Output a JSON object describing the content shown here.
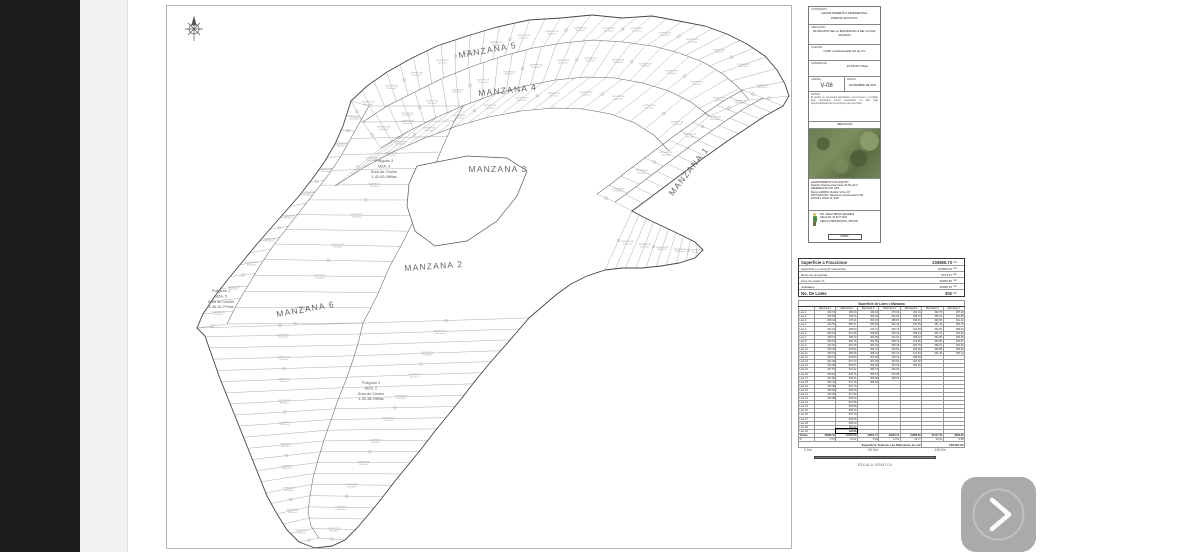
{
  "colors": {
    "viewer_bar": "#1c1c1e",
    "next_button_bg": "#a8aaac",
    "map_line": "#555555",
    "photo_green": "#6b7d52"
  },
  "viewer": {
    "next_button": {
      "icon": "chevron-right-icon"
    }
  },
  "sheet": {
    "map": {
      "manzana_labels": [
        {
          "text": "MANZANA 5",
          "x": 321,
          "y": 47,
          "rot": -10
        },
        {
          "text": "MANZANA 4",
          "x": 341,
          "y": 87,
          "rot": -6
        },
        {
          "text": "MANZANA 3",
          "x": 331,
          "y": 166,
          "rot": 0
        },
        {
          "text": "MANZANA 2",
          "x": 267,
          "y": 263,
          "rot": -4
        },
        {
          "text": "MANZANA 6",
          "x": 139,
          "y": 306,
          "rot": -10
        },
        {
          "text": "MANZANA 1",
          "x": 524,
          "y": 167,
          "rot": -52
        }
      ],
      "polygon_notes": [
        {
          "x": 217,
          "y": 156,
          "lines": [
            "Polígono 3",
            "MZA. 3",
            "Área de Cesión",
            "1-41-63.08Has"
          ]
        },
        {
          "x": 54,
          "y": 286,
          "lines": [
            "Polígono 1",
            "MZA. 5",
            "Área de Cesión",
            "4-46-16.27Has"
          ]
        },
        {
          "x": 204,
          "y": 378,
          "lines": [
            "Polígono 2",
            "MZA. 2",
            "Área de Cesión",
            "1-31-38.04Has"
          ]
        }
      ],
      "lot_label_sample": {
        "line1": "SUPERFICIE",
        "line2": "300.00m2"
      }
    },
    "title_block": {
      "contenido_label": "CONTENIDO:",
      "contenido1": "LEVANTAMIENTO PERIMETRAL",
      "contenido2": "PREDIO RUSTICO",
      "ubicacion_label": "UBICACION:",
      "ubicacion": "MUNICIPIO DE LA MANZANILLA DE LA PAZ, JALISCO",
      "cliente_label": "CLIENTE:",
      "cliente": "CORI La Manzanilla SA de CV",
      "superficie_label": "SUPERFICIE:",
      "superficie": "23-08-55.73Has",
      "lamina_label": "LAMINA:",
      "lamina": "V-08",
      "fecha_label": "FECHA:",
      "fecha": "NOVIEMBRE DE 2023",
      "notas_label": "NOTAS:",
      "notas": "El predio se encuentra delimitado y los linderos y medidas aquí mostrados fueron levantados en sitio bajo responsabilidad de los técnicos que suscriben.",
      "mapa_label": "UBICACION",
      "equipo_lines": [
        "LEVANTAMIENTO CON EQUIPO:",
        "Estación Total Geomax Zoom 30 Pro A6 X",
        "REFERENCIA CON GPS",
        "Marca GARMIN, Modelo \"eTrex 10\"",
        "PROYECCION: Sistema de coordenadas UTM",
        "WGS-84, ZONA 13, SUR"
      ],
      "firma_lines": [
        "ING. DIEGO BRAVO NEGRETE",
        "CELULAR: 33 3477 6403",
        "CEDULA PROFESIONAL: 5567234"
      ],
      "firma_box": "FIRMA"
    },
    "summary_table": {
      "rows": [
        {
          "label": "Superficie a Fraccionar",
          "value": "230855.73",
          "unit": "m2",
          "bold": true
        },
        {
          "label": "Superficie en venta (8 manzanas)",
          "value": "166655.02",
          "unit": "m2",
          "bold": false
        },
        {
          "label": "Resto de propiedad",
          "value": "6074.37",
          "unit": "m2",
          "bold": false
        },
        {
          "label": "Área de cesión        %",
          "value": "28056.85",
          "unit": "m2",
          "bold": false
        },
        {
          "label": "vialidades",
          "value": "25095.63",
          "unit": "m2",
          "bold": false
        },
        {
          "label": "No. De Lotes",
          "value": "302",
          "unit": "Pts",
          "bold": true
        }
      ]
    },
    "lot_table": {
      "title": "Superficie de Lotes x Manzana",
      "columns": [
        "",
        "Manzana 1",
        "Manzana 2",
        "Manzana 3",
        "Manzana 4",
        "Manzana 5",
        "Manzana 6",
        "Manzana 7"
      ],
      "rows": [
        {
          "l": "Lote 1",
          "c": [
            "302.15",
            "465.20",
            "346.18",
            "378.92",
            "451.10",
            "362.75",
            "287.40"
          ]
        },
        {
          "l": "Lote 2",
          "c": [
            "315.80",
            "492.64",
            "352.30",
            "391.45",
            "448.72",
            "355.18",
            "292.85"
          ]
        },
        {
          "l": "Lote 3",
          "c": [
            "298.42",
            "478.11",
            "360.25",
            "385.60",
            "459.31",
            "348.90",
            "301.12"
          ]
        },
        {
          "l": "Lote 4",
          "c": [
            "310.55",
            "505.37",
            "355.48",
            "402.18",
            "470.25",
            "351.42",
            "296.70"
          ]
        },
        {
          "l": "Lote 5",
          "c": [
            "322.18",
            "488.90",
            "349.12",
            "398.75",
            "462.80",
            "360.05",
            "288.94"
          ]
        },
        {
          "l": "Lote 6",
          "c": [
            "305.92",
            "512.45",
            "358.60",
            "405.32",
            "455.14",
            "357.22",
            "294.36"
          ]
        },
        {
          "l": "Lote 7",
          "c": [
            "318.27",
            "495.72",
            "362.85",
            "412.90",
            "468.42",
            "352.60",
            "299.48"
          ]
        },
        {
          "l": "Lote 8",
          "c": [
            "300.64",
            "520.18",
            "351.95",
            "408.15",
            "472.90",
            "346.85",
            "290.57"
          ]
        },
        {
          "l": "Lote 9",
          "c": [
            "312.81",
            "502.35",
            "365.20",
            "395.48",
            "460.75",
            "358.12",
            "302.26"
          ]
        },
        {
          "l": "Lote 10",
          "c": [
            "325.48",
            "515.82",
            "354.70",
            "415.60",
            "466.38",
            "349.85",
            "286.92"
          ]
        },
        {
          "l": "Lote 11",
          "c": [
            "308.15",
            "498.26",
            "368.42",
            "401.22",
            "471.84",
            "361.48",
            "295.14"
          ]
        },
        {
          "l": "Lote 12",
          "c": [
            "320.72",
            "524.60",
            "357.90",
            "418.35",
            "458.26",
            "",
            ""
          ]
        },
        {
          "l": "Lote 13",
          "c": [
            "302.38",
            "507.14",
            "361.25",
            "394.80",
            "464.52",
            "",
            ""
          ]
        },
        {
          "l": "Lote 14",
          "c": [
            "314.95",
            "519.87",
            "352.48",
            "410.46",
            "469.15",
            "",
            ""
          ]
        },
        {
          "l": "Lote 15",
          "c": [
            "327.52",
            "501.32",
            "366.70",
            "406.92",
            "",
            "",
            ""
          ]
        },
        {
          "l": "Lote 16",
          "c": [
            "309.18",
            "526.75",
            "356.15",
            "413.58",
            "",
            "",
            ""
          ]
        },
        {
          "l": "Lote 17",
          "c": [
            "321.85",
            "508.41",
            "369.38",
            "399.24",
            "",
            "",
            ""
          ]
        },
        {
          "l": "Lote 18",
          "c": [
            "303.42",
            "531.16",
            "358.62",
            "",
            "",
            "",
            ""
          ]
        },
        {
          "l": "Lote 19",
          "c": [
            "316.08",
            "513.70",
            "",
            "",
            "",
            "",
            ""
          ]
        },
        {
          "l": "Lote 20",
          "c": [
            "328.65",
            "535.28",
            "",
            "",
            "",
            "",
            ""
          ]
        },
        {
          "l": "Lote 21",
          "c": [
            "310.22",
            "517.84",
            "",
            "",
            "",
            "",
            ""
          ]
        },
        {
          "l": "Lote 22",
          "c": [
            "322.88",
            "539.42",
            "",
            "",
            "",
            "",
            ""
          ]
        },
        {
          "l": "Lote 23",
          "c": [
            "",
            "521.95",
            "",
            "",
            "",
            "",
            ""
          ]
        },
        {
          "l": "Lote 24",
          "c": [
            "",
            "543.58",
            "",
            "",
            "",
            "",
            ""
          ]
        },
        {
          "l": "Lote 25",
          "c": [
            "",
            "526.12",
            "",
            "",
            "",
            "",
            ""
          ]
        },
        {
          "l": "Lote 26",
          "c": [
            "",
            "547.70",
            "",
            "",
            "",
            "",
            ""
          ]
        },
        {
          "l": "Lote 27",
          "c": [
            "",
            "530.25",
            "",
            "",
            "",
            "",
            ""
          ]
        },
        {
          "l": "Lote 28",
          "c": [
            "",
            "538.40",
            "",
            "",
            "",
            "",
            ""
          ]
        },
        {
          "l": "Lote 29",
          "c": [
            "",
            "150.84",
            "",
            "",
            "",
            "",
            ""
          ]
        },
        {
          "l": "Lote 30",
          "c": [
            "",
            "128.98",
            "",
            "",
            "",
            "",
            ""
          ]
        }
      ],
      "boxed_cell": {
        "row": 29,
        "col": 1
      },
      "totals_label": "Totales",
      "totals": [
        "30888.02",
        "47560.39",
        "22851.77",
        "29940.41",
        "24888.69",
        "31417.40",
        "8893.36"
      ],
      "percent_label": "%",
      "percents": [
        "5.07",
        "19.61",
        "9.46",
        "11.00",
        "14.77",
        "13.41",
        "6.58"
      ],
      "footer_label": "Superficie Total de Las Manzanas en m2",
      "footer_value": "166440.02"
    },
    "scale_bar": {
      "ticks": [
        "0.0m",
        "50.0m",
        "100.0m"
      ],
      "caption": "ESCALA GRAFICA"
    }
  }
}
